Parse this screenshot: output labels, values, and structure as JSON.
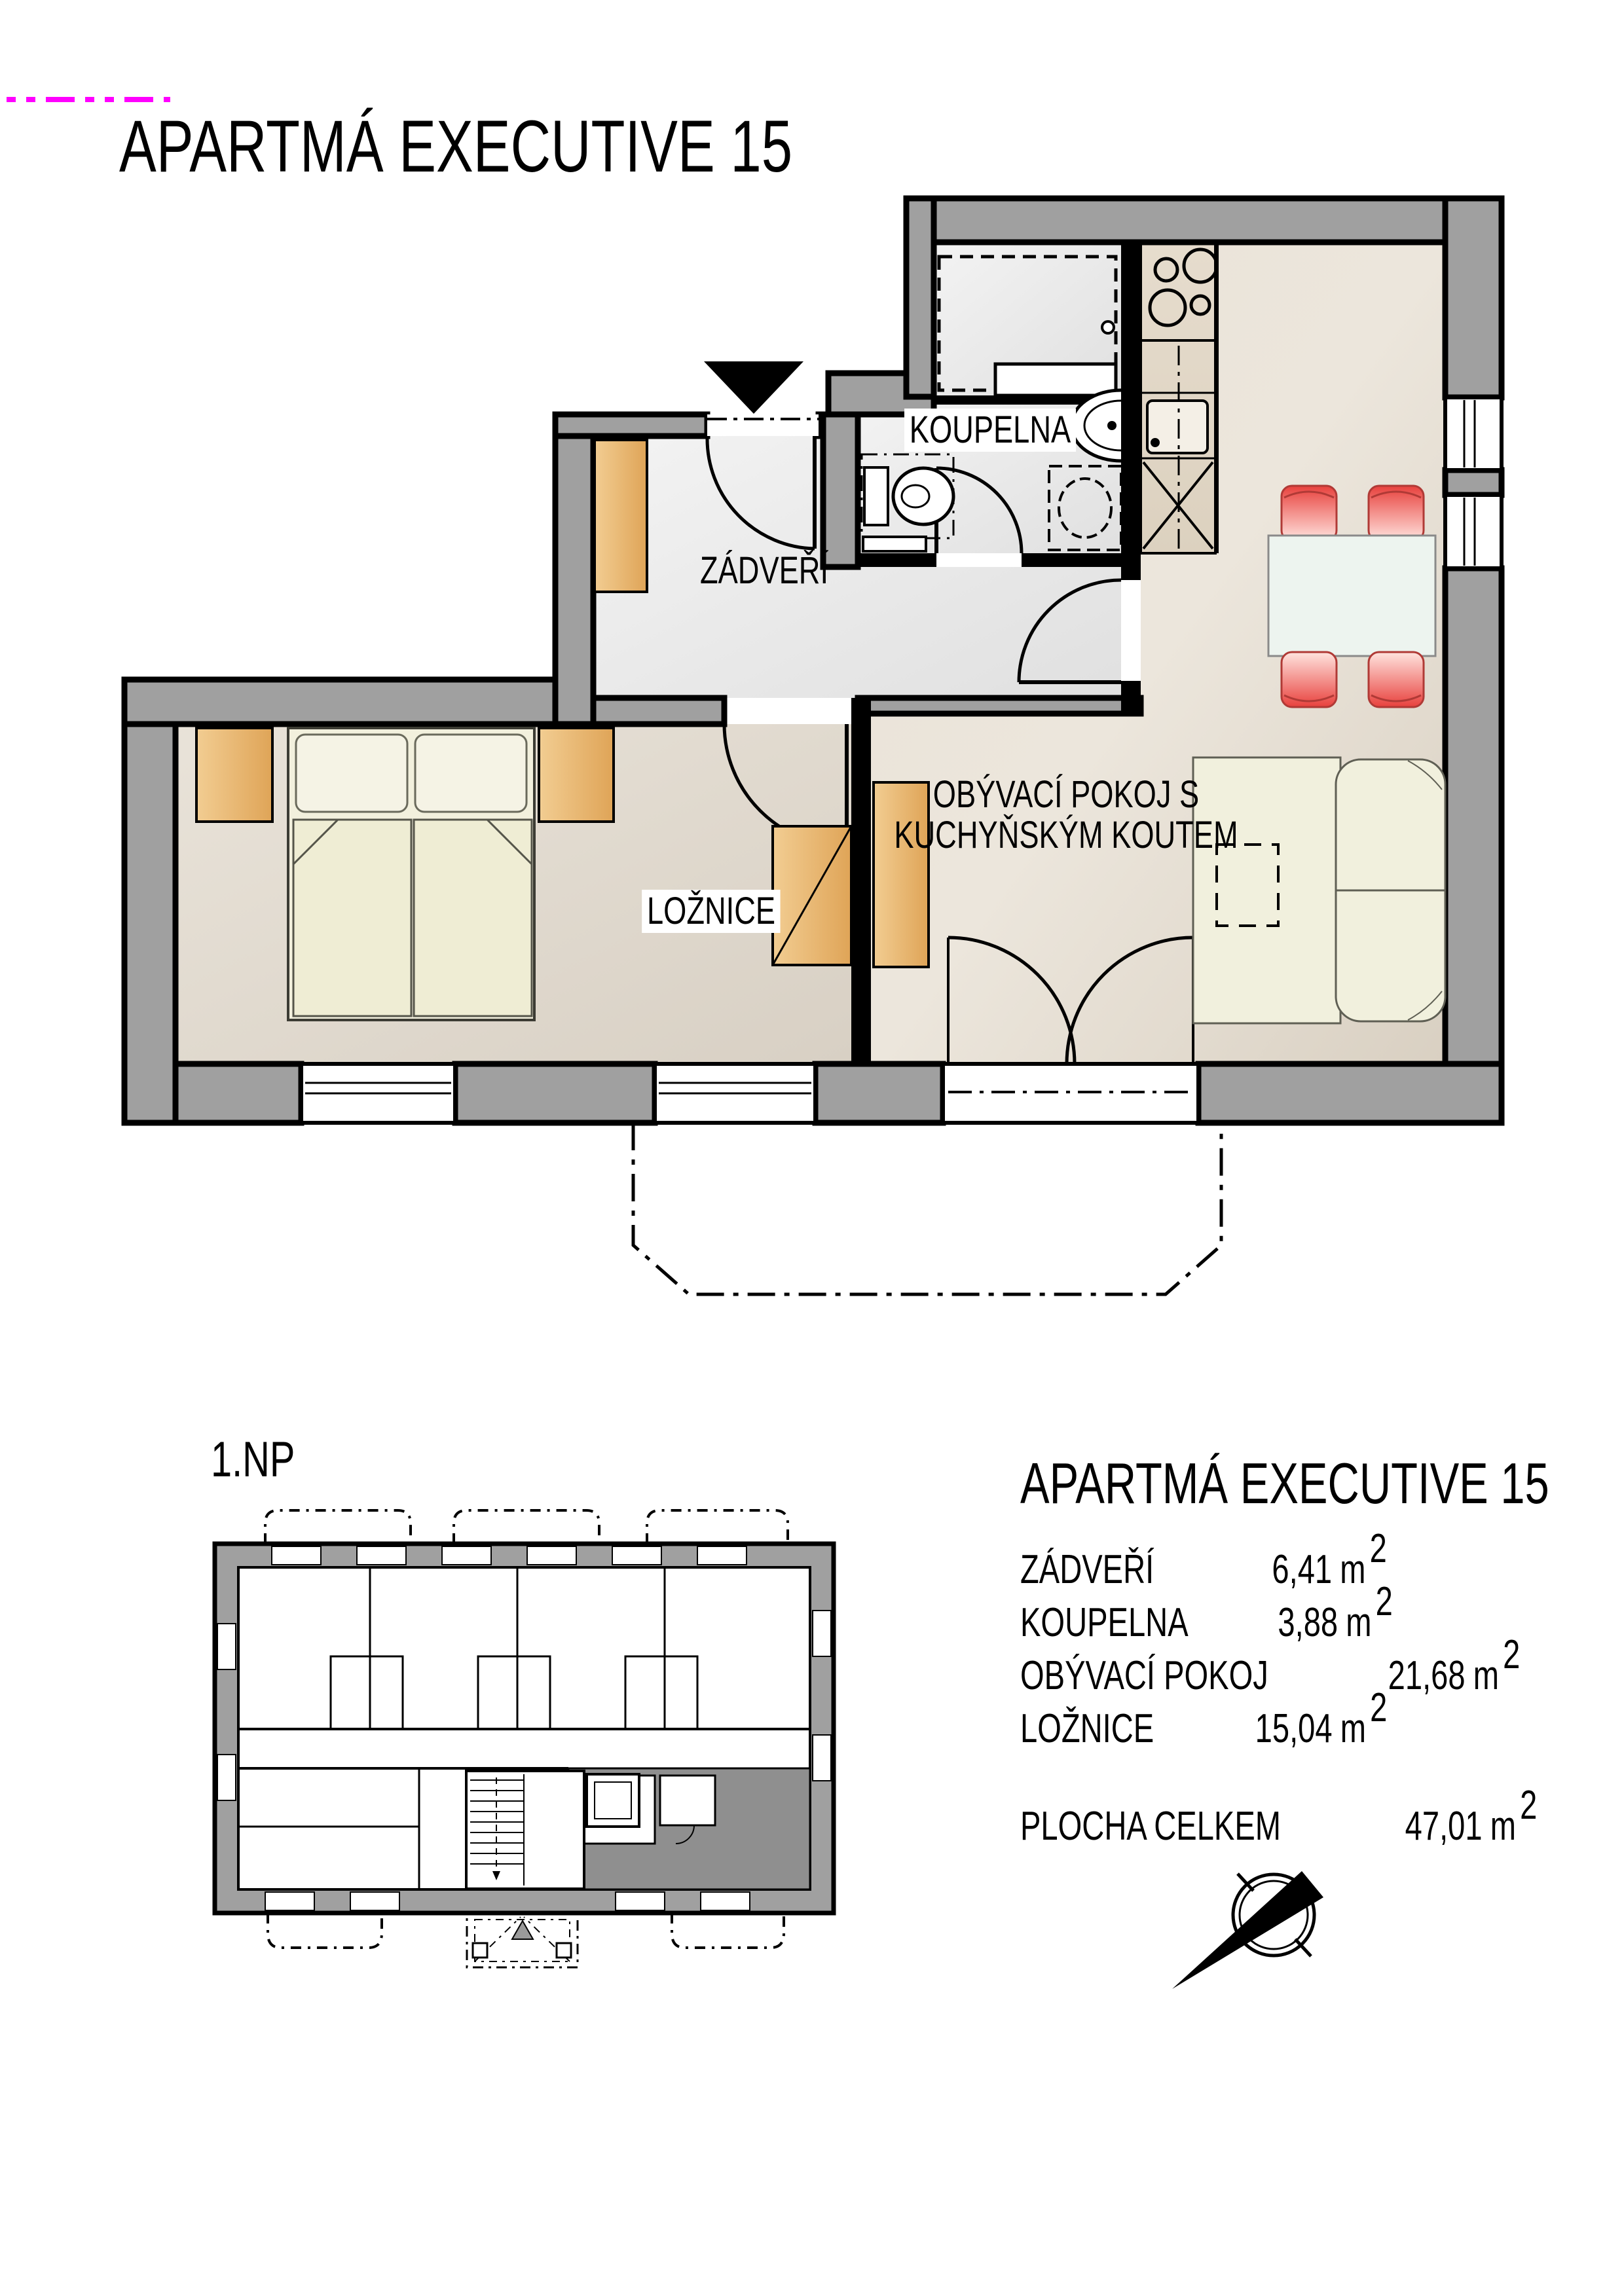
{
  "title": "APARTMÁ EXECUTIVE 15",
  "floor_label": "1.NP",
  "rooms": {
    "zadveri": "ZÁDVEŘÍ",
    "koupelna": "KOUPELNA",
    "obyvaci_line1": "OBÝVACÍ POKOJ S",
    "obyvaci_line2": "KUCHYŇSKÝM KOUTEM",
    "loznice": "LOŽNICE"
  },
  "legend": {
    "title": "APARTMÁ EXECUTIVE 15",
    "unit": "m",
    "sup": "2",
    "rows": [
      {
        "label": "ZÁDVEŘÍ",
        "value": "6,41"
      },
      {
        "label": "KOUPELNA",
        "value": "3,88"
      },
      {
        "label": "OBÝVACÍ POKOJ",
        "value": "21,68"
      },
      {
        "label": "LOŽNICE",
        "value": "15,04"
      }
    ],
    "total": {
      "label": "PLOCHA CELKEM",
      "value": "47,01"
    }
  },
  "icons": {
    "north_arrow": "north-arrow-icon",
    "entrance_arrow": "entrance-arrow-icon"
  },
  "colors": {
    "wall_gray": "#a0a0a0",
    "partition_black": "#000000",
    "furniture_orange": "#e8b264",
    "chair_red": "#ea4d49",
    "bed_cream": "#f1efdb",
    "table_glass": "#edf4ef",
    "overview_highlight": "#8f8f8f",
    "registration_magenta": "#ff00ff"
  }
}
